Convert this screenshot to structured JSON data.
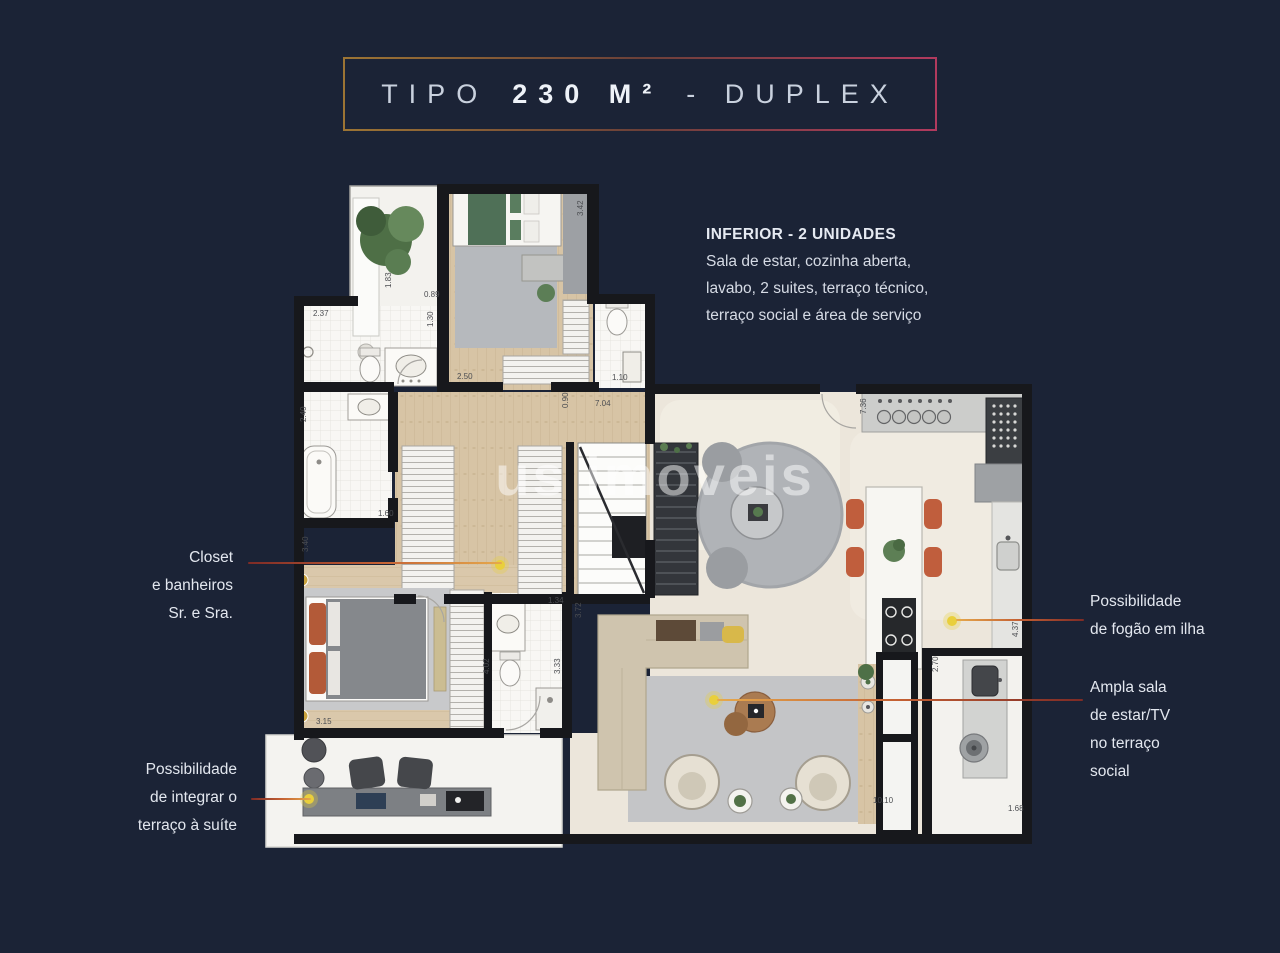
{
  "title_box": {
    "word1": "TIPO",
    "word2": "230 M²",
    "word3": "- DUPLEX"
  },
  "description": {
    "heading": "INFERIOR - 2 UNIDADES",
    "lines": [
      "Sala de estar, cozinha aberta,",
      "lavabo, 2 suites, terraço técnico,",
      "terraço social e área de serviço"
    ]
  },
  "callouts": {
    "closet": {
      "lines": [
        "Closet",
        "e banheiros",
        "Sr. e Sra."
      ]
    },
    "terrace_suite": {
      "lines": [
        "Possibilidade",
        "de integrar o",
        "terraço à suíte"
      ]
    },
    "island_stove": {
      "lines": [
        "Possibilidade",
        "de fogão em ilha"
      ]
    },
    "terrace_living": {
      "lines": [
        "Ampla sala",
        "de estar/TV",
        "no terraço",
        "social"
      ]
    }
  },
  "watermark": "us imoveis",
  "floor_plan": {
    "dimension_labels": [
      {
        "value": "2.37",
        "x": 313,
        "y": 316
      },
      {
        "value": "1.83",
        "x": 391,
        "y": 288,
        "vertical": true
      },
      {
        "value": "0.89",
        "x": 424,
        "y": 297
      },
      {
        "value": "1.30",
        "x": 433,
        "y": 327,
        "vertical": true
      },
      {
        "value": "3.42",
        "x": 583,
        "y": 216,
        "vertical": true
      },
      {
        "value": "2.50",
        "x": 457,
        "y": 379
      },
      {
        "value": "7.04",
        "x": 595,
        "y": 406
      },
      {
        "value": "0.90",
        "x": 568,
        "y": 408,
        "vertical": true
      },
      {
        "value": "1.10",
        "x": 612,
        "y": 380
      },
      {
        "value": "2.40",
        "x": 306,
        "y": 422,
        "vertical": true
      },
      {
        "value": "3.40",
        "x": 308,
        "y": 552,
        "vertical": true
      },
      {
        "value": "1.60",
        "x": 378,
        "y": 516
      },
      {
        "value": "7.36",
        "x": 866,
        "y": 414,
        "vertical": true
      },
      {
        "value": "3.15",
        "x": 316,
        "y": 724
      },
      {
        "value": "1.34",
        "x": 548,
        "y": 603
      },
      {
        "value": "3.72",
        "x": 581,
        "y": 618,
        "vertical": true
      },
      {
        "value": "4.02",
        "x": 489,
        "y": 674,
        "vertical": true
      },
      {
        "value": "3.33",
        "x": 560,
        "y": 674,
        "vertical": true
      },
      {
        "value": "2.70",
        "x": 938,
        "y": 672,
        "vertical": true
      },
      {
        "value": "4.37",
        "x": 1018,
        "y": 637,
        "vertical": true
      },
      {
        "value": "10.10",
        "x": 873,
        "y": 803
      },
      {
        "value": "1.68",
        "x": 1008,
        "y": 811
      }
    ]
  },
  "colors": {
    "background": "#1b2336",
    "title_border_start": "#9c7434",
    "title_border_end": "#b13a5e",
    "callout_line_warm": "#c35f33",
    "callout_line_dark": "#7e2b26",
    "callout_dot": "#e9cf3c",
    "accent_terracotta": "#c05e3d",
    "plan_wall": "#17181c",
    "floor_wood": "#d7c4a5",
    "floor_marble": "#ece6db",
    "rug_gray": "#b0b3b7"
  }
}
